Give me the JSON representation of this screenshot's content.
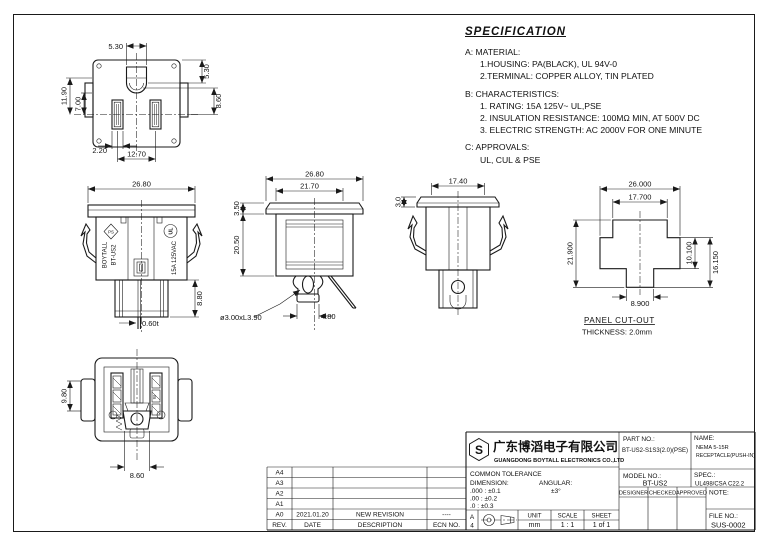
{
  "spec": {
    "title": "SPECIFICATION",
    "a_header": "A: MATERIAL:",
    "a1": "1.HOUSING: PA(BLACK), UL 94V-0",
    "a2": "2.TERMINAL: COPPER ALLOY, TIN PLATED",
    "b_header": "B: CHARACTERISTICS:",
    "b1": "1. RATING: 15A 125V~ UL,PSE",
    "b2": "2. INSULATION RESISTANCE: 100MΩ MIN, AT 500V DC",
    "b3": "3. ELECTRIC STRENGTH: AC 2000V FOR ONE MINUTE",
    "c_header": "C: APPROVALS:",
    "c1": "UL, CUL & PSE"
  },
  "views": {
    "front": {
      "dims": {
        "gap_top": "5.30",
        "hole_side": "5.30",
        "left_outer": "11.90",
        "left_inner": "7.00",
        "right_lower": "8.60",
        "slot_width": "2.20",
        "slot_pitch": "12.70"
      }
    },
    "side": {
      "dims": {
        "width": "26.80",
        "depth": "8.80",
        "thickness": "0.60t"
      },
      "marks": {
        "brand": "BOYTALL",
        "model": "BT-US2",
        "rating": "15A 125VAC",
        "pse": "PS",
        "ul": "UL"
      }
    },
    "section": {
      "dims": {
        "width": "26.80",
        "inner_width": "21.70",
        "flange": "3.50",
        "depth": "20.50",
        "pin": "ø3.00xL3.90",
        "pin_base": "4.80"
      }
    },
    "sideb": {
      "dims": {
        "width": "17.40",
        "flange": "3.0"
      }
    },
    "cutout": {
      "dims": {
        "width": "26.000",
        "top_width": "17.700",
        "height": "21.900",
        "band": "10.100",
        "lower": "16.150",
        "bottom": "8.900"
      },
      "label1": "PANEL CUT-OUT",
      "label2": "THICKNESS: 2.0mm"
    },
    "rear": {
      "dims": {
        "side": "9.80",
        "bottom": "8.60"
      },
      "marks": {
        "w": "W"
      }
    }
  },
  "titleblock": {
    "logo_letter": "S",
    "company_cn": "广东博滔电子有限公司",
    "company_en": "GUANGDONG BOYTALL ELECTRONICS CO.,LTD",
    "part_no_label": "PART NO.:",
    "part_no": "BT-US2-S1S3(2.0)(PSE)",
    "name_label": "NAME:",
    "name_line1": "NEMA 5-15R",
    "name_line2": "RECEPTACLE(PUSH-IN)",
    "model_no_label": "MODEL NO.:",
    "model_no": "BT-US2",
    "spec_label": "SPEC.:",
    "spec_value": "UL498/CSA C22.2",
    "designer_label": "DESIGNER",
    "checked_label": "CHECKED",
    "approved_label": "APPROVED",
    "note_label": "NOTE:",
    "file_no_label": "FILE NO.:",
    "file_no": "SUS-0002",
    "tolerance": {
      "title": "COMMON TOLERANCE",
      "dim_label": "DIMENSION:",
      "ang_label": "ANGULAR:",
      "row1_left": ".000 : ±0.1",
      "row1_right": "±3°",
      "row2_left": ".00  : ±0.2",
      "row3_left": ".0   : ±0.3"
    },
    "paper_line1": "A",
    "paper_line2": "4",
    "unit_label": "UNIT",
    "unit": "mm",
    "scale_label": "SCALE",
    "scale": "1 : 1",
    "sheet_label": "SHEET",
    "sheet": "1 of 1"
  },
  "revisions": {
    "headers": {
      "rev": "REV.",
      "date": "DATE",
      "desc": "DESCRIPTION",
      "ecn": "ECN NO."
    },
    "rows": [
      {
        "rev": "A4",
        "date": "",
        "desc": "",
        "ecn": ""
      },
      {
        "rev": "A3",
        "date": "",
        "desc": "",
        "ecn": ""
      },
      {
        "rev": "A2",
        "date": "",
        "desc": "",
        "ecn": ""
      },
      {
        "rev": "A1",
        "date": "",
        "desc": "",
        "ecn": ""
      },
      {
        "rev": "A0",
        "date": "2021.01.20",
        "desc": "NEW REVISION",
        "ecn": "----"
      }
    ]
  }
}
